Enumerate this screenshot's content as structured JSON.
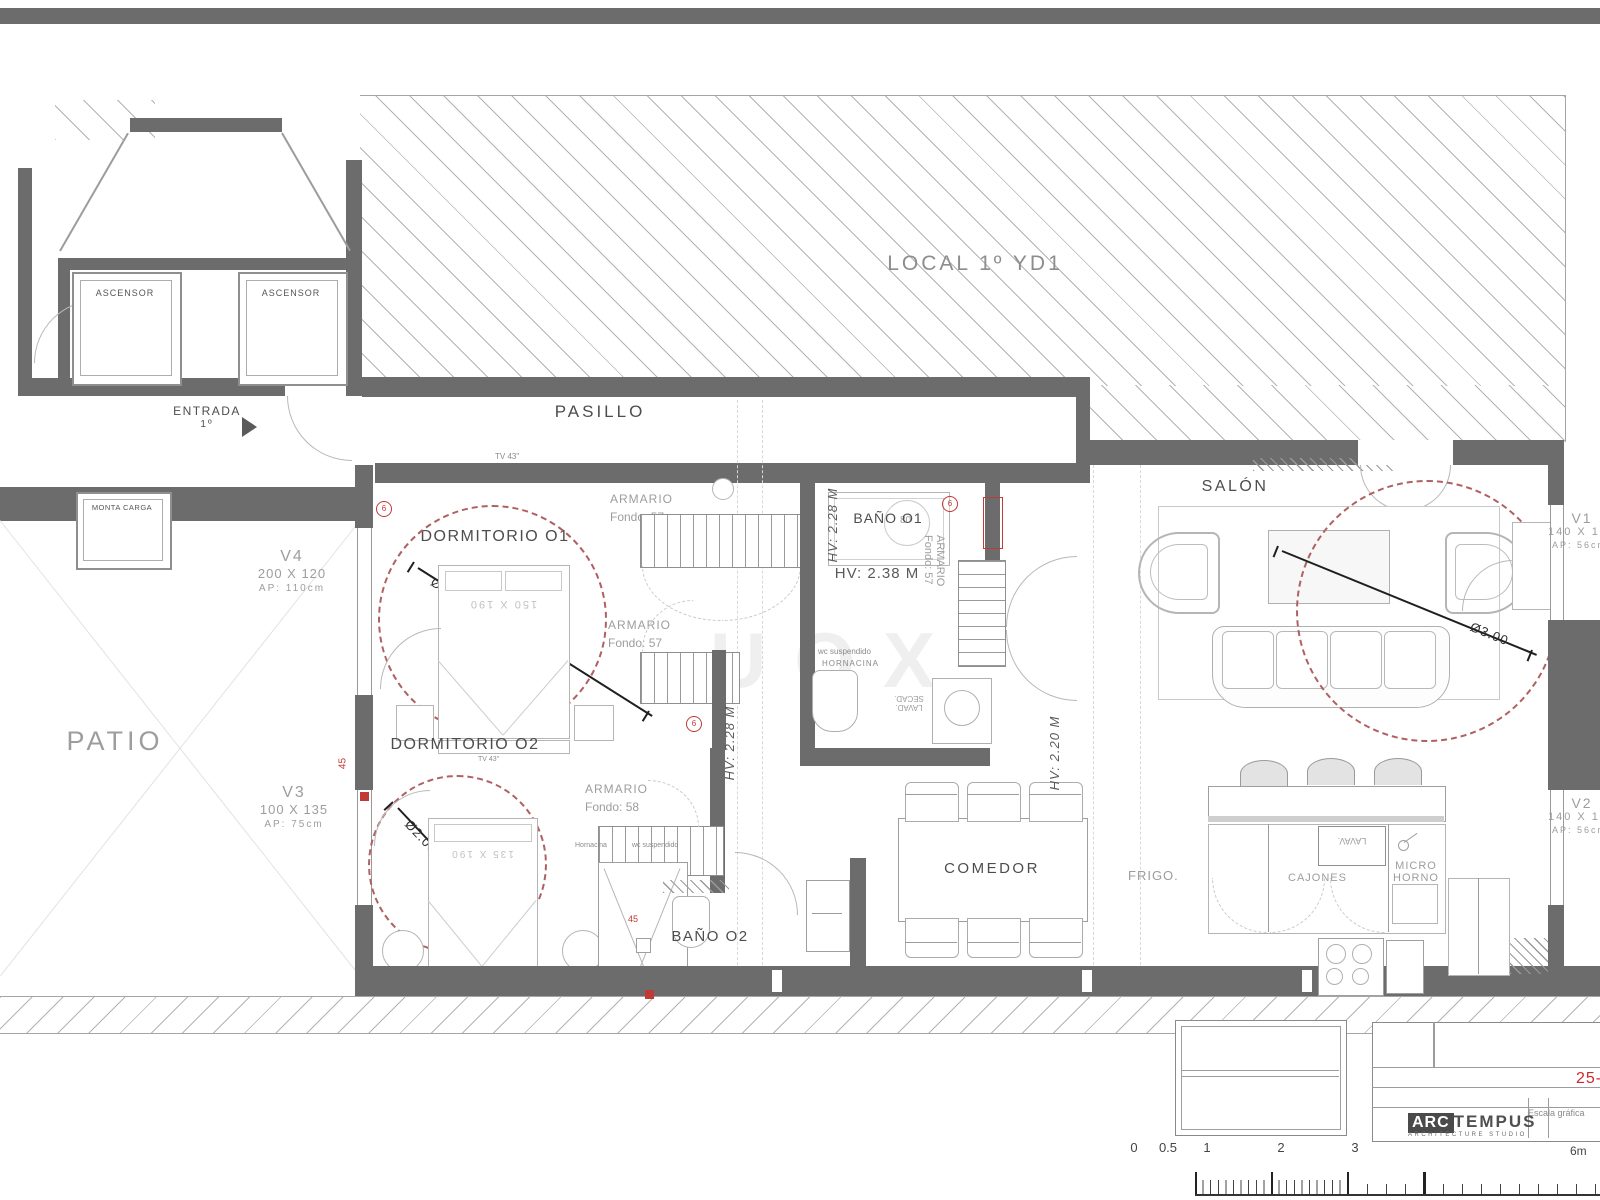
{
  "colors": {
    "wall": "#6c6c6c",
    "hatch_line": "#b3b3b3",
    "label_dark": "#4d4d4d",
    "label_muted": "#9d9d9d",
    "red_accent": "#c03a36",
    "dash_circle_red": "#b06060",
    "sheet_number_red": "#cc2a2a"
  },
  "zones": {
    "local": "LOCAL 1º YD1",
    "pasillo": "PASILLO",
    "patio": "PATIO",
    "entrada": "ENTRADA",
    "entrada_floor": "1º",
    "ascensor": "ASCENSOR",
    "monta_carga": "MONTA CARGA",
    "dormitorio_1": "DORMITORIO O1",
    "dormitorio_2": "DORMITORIO O2",
    "bano_1": "BAÑO O1",
    "bano_2": "BAÑO O2",
    "salon": "SALÓN",
    "comedor": "COMEDOR",
    "cocina": "COCINA"
  },
  "windows": {
    "v1": {
      "id": "V1",
      "size": "140 X 170",
      "sill": "AP: 56cm"
    },
    "v2": {
      "id": "V2",
      "size": "140 X 170",
      "sill": "AP: 56cm"
    },
    "v3": {
      "id": "V3",
      "size": "100 X 135",
      "sill": "AP: 75cm"
    },
    "v4": {
      "id": "V4",
      "size": "200 X 120",
      "sill": "AP: 110cm"
    }
  },
  "annotations": {
    "armario": "ARMARIO",
    "fondo_57": "Fondo: 57",
    "fondo_58": "Fondo: 58",
    "hv_228": "HV: 2.28 M",
    "hv_238": "HV: 2.38 M",
    "hv_220": "HV: 2.20 M",
    "diam_270": "Ø2.70",
    "diam_200": "Ø2.00",
    "diam_300": "Ø3.00",
    "bed_1": "150 X 190",
    "bed_2": "135 X 190",
    "tv": "TV 43\"",
    "wc_susp": "wc suspendido",
    "hornacina_caps": "HORNACINA",
    "hornacina": "Hornacina",
    "lavad": "LAVAD.",
    "secad": "SECAD.",
    "lavav": "LAVAV.",
    "frigo": "FRIGO.",
    "cajones": "CAJONES",
    "micro_line1": "MICRO",
    "micro_line2": "HORNO",
    "shower_45": "45",
    "shower_80": "80",
    "pillar_mark": "6"
  },
  "titleblock": {
    "sheet_no": "25-",
    "escala": "Escala gráfica",
    "logo_arc": "ARC",
    "logo_tempus": "TEMPUS",
    "logo_sub": "ARCHITECTURE STUDIO",
    "scale_max": "6m",
    "scale_ticks": [
      "0",
      "0.5",
      "1",
      "2",
      "3"
    ]
  },
  "watermark": {
    "left": "L",
    "right": "UOX"
  }
}
